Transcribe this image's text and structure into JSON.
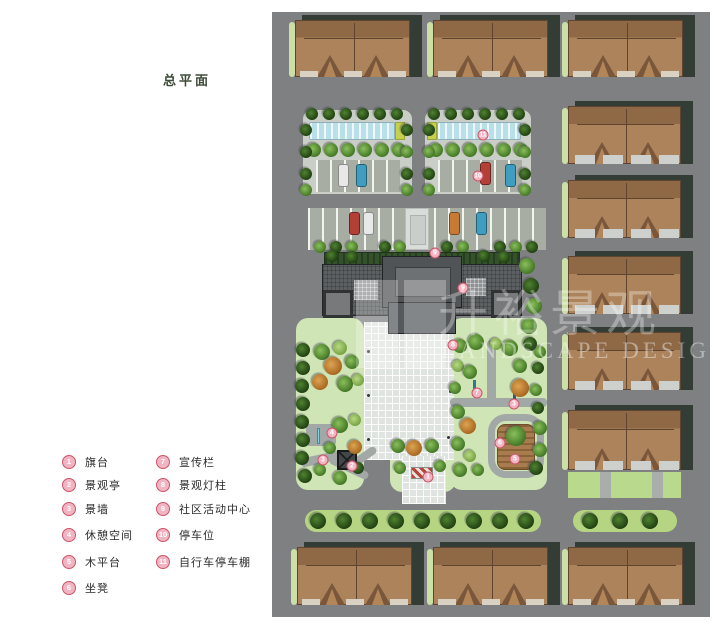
{
  "title": "总平面",
  "watermark": {
    "cn": "升裕景观",
    "en": "LANDSCAPE DESIGN"
  },
  "legend": {
    "col1": [
      {
        "n": "1",
        "label": "旗台"
      },
      {
        "n": "2",
        "label": "景观亭"
      },
      {
        "n": "3",
        "label": "景墙"
      },
      {
        "n": "4",
        "label": "休憩空间"
      },
      {
        "n": "5",
        "label": "木平台"
      },
      {
        "n": "6",
        "label": "坐凳"
      }
    ],
    "col2": [
      {
        "n": "7",
        "label": "宣传栏"
      },
      {
        "n": "8",
        "label": "景观灯柱"
      },
      {
        "n": "9",
        "label": "社区活动中心"
      },
      {
        "n": "10",
        "label": "停车位"
      },
      {
        "n": "11",
        "label": "自行车停车棚"
      }
    ]
  },
  "colors": {
    "road": "#7e8082",
    "roof": "#ad835b",
    "roofDark": "#8f6845",
    "shadow": "#343d35",
    "hedge": "#b5d583",
    "bed": "#cfe5b5",
    "plaza": "#e0e4e0",
    "shed": "#b9dfe8",
    "marker": "#cc5468",
    "carRed": "#b33f36",
    "carBlue": "#3f9ec0",
    "carOrange": "#c77a35",
    "carWhite": "#e8e8e8"
  },
  "plan": {
    "items": [
      {
        "t": "pad",
        "x": 31,
        "y": 98,
        "w": 109,
        "h": 84
      },
      {
        "t": "pad",
        "x": 153,
        "y": 98,
        "w": 106,
        "h": 84
      },
      {
        "t": "house",
        "x": 23,
        "y": 8,
        "w": 115,
        "h": 57,
        "v": "a"
      },
      {
        "t": "house",
        "x": 161,
        "y": 8,
        "w": 115,
        "h": 57,
        "v": "a"
      },
      {
        "t": "house",
        "x": 296,
        "y": 8,
        "w": 115,
        "h": 57,
        "v": "a"
      },
      {
        "t": "house",
        "x": 296,
        "y": 94,
        "w": 113,
        "h": 58,
        "v": "b"
      },
      {
        "t": "house",
        "x": 296,
        "y": 168,
        "w": 113,
        "h": 58,
        "v": "b"
      },
      {
        "t": "house",
        "x": 296,
        "y": 244,
        "w": 113,
        "h": 58,
        "v": "b"
      },
      {
        "t": "house",
        "x": 296,
        "y": 320,
        "w": 113,
        "h": 58,
        "v": "b"
      },
      {
        "t": "house",
        "x": 296,
        "y": 398,
        "w": 113,
        "h": 60,
        "v": "b"
      },
      {
        "t": "house",
        "x": 25,
        "y": 535,
        "w": 115,
        "h": 58,
        "v": "a"
      },
      {
        "t": "house",
        "x": 161,
        "y": 535,
        "w": 115,
        "h": 58,
        "v": "a"
      },
      {
        "t": "house",
        "x": 296,
        "y": 535,
        "w": 115,
        "h": 58,
        "v": "a"
      },
      {
        "t": "shed",
        "x": 37,
        "y": 110,
        "w": 86,
        "h": 18
      },
      {
        "t": "cap",
        "x": 123,
        "y": 110,
        "w": 10,
        "h": 18
      },
      {
        "t": "cap",
        "x": 155,
        "y": 110,
        "w": 10,
        "h": 18
      },
      {
        "t": "shed",
        "x": 165,
        "y": 110,
        "w": 84,
        "h": 18
      },
      {
        "t": "stalls",
        "x": 44,
        "y": 148,
        "w": 84,
        "h": 32
      },
      {
        "t": "stalls",
        "x": 166,
        "y": 148,
        "w": 84,
        "h": 32
      },
      {
        "t": "stalls",
        "x": 36,
        "y": 196,
        "w": 238,
        "h": 42
      },
      {
        "t": "walk",
        "x": 133,
        "y": 196,
        "w": 24,
        "h": 42
      },
      {
        "t": "trow",
        "x": 40,
        "y": 102,
        "n": 6,
        "dx": 17,
        "r": 6,
        "p": "dark"
      },
      {
        "t": "trow",
        "x": 162,
        "y": 102,
        "n": 6,
        "dx": 17,
        "r": 6,
        "p": "dark"
      },
      {
        "t": "trow",
        "x": 42,
        "y": 138,
        "n": 6,
        "dx": 17,
        "r": 7,
        "p": "green"
      },
      {
        "t": "trow",
        "x": 164,
        "y": 138,
        "n": 6,
        "dx": 17,
        "r": 7,
        "p": "green"
      },
      {
        "t": "tree",
        "x": 34,
        "y": 118,
        "r": 6,
        "p": "dark"
      },
      {
        "t": "tree",
        "x": 34,
        "y": 140,
        "r": 6,
        "p": "dark"
      },
      {
        "t": "tree",
        "x": 34,
        "y": 162,
        "r": 6,
        "p": "dark"
      },
      {
        "t": "tree",
        "x": 34,
        "y": 178,
        "r": 6,
        "p": "green"
      },
      {
        "t": "tree",
        "x": 135,
        "y": 118,
        "r": 6,
        "p": "dark"
      },
      {
        "t": "tree",
        "x": 135,
        "y": 140,
        "r": 6,
        "p": "green"
      },
      {
        "t": "tree",
        "x": 135,
        "y": 162,
        "r": 6,
        "p": "dark"
      },
      {
        "t": "tree",
        "x": 135,
        "y": 178,
        "r": 6,
        "p": "green"
      },
      {
        "t": "tree",
        "x": 157,
        "y": 118,
        "r": 6,
        "p": "dark"
      },
      {
        "t": "tree",
        "x": 157,
        "y": 140,
        "r": 6,
        "p": "green"
      },
      {
        "t": "tree",
        "x": 157,
        "y": 162,
        "r": 6,
        "p": "dark"
      },
      {
        "t": "tree",
        "x": 157,
        "y": 178,
        "r": 6,
        "p": "green"
      },
      {
        "t": "tree",
        "x": 253,
        "y": 118,
        "r": 6,
        "p": "dark"
      },
      {
        "t": "tree",
        "x": 253,
        "y": 140,
        "r": 6,
        "p": "green"
      },
      {
        "t": "tree",
        "x": 253,
        "y": 162,
        "r": 6,
        "p": "dark"
      },
      {
        "t": "tree",
        "x": 253,
        "y": 178,
        "r": 6,
        "p": "green"
      },
      {
        "t": "car",
        "x": 66,
        "y": 152,
        "c": "#e8e8e8"
      },
      {
        "t": "car",
        "x": 84,
        "y": 152,
        "c": "#3f9ec0"
      },
      {
        "t": "car",
        "x": 208,
        "y": 150,
        "c": "#b33f36"
      },
      {
        "t": "car",
        "x": 233,
        "y": 152,
        "c": "#3f9ec0"
      },
      {
        "t": "car",
        "x": 77,
        "y": 200,
        "c": "#b33f36"
      },
      {
        "t": "car",
        "x": 91,
        "y": 200,
        "c": "#e8e8e8"
      },
      {
        "t": "car",
        "x": 177,
        "y": 200,
        "c": "#c77a35"
      },
      {
        "t": "car",
        "x": 204,
        "y": 200,
        "c": "#3f9ec0"
      },
      {
        "t": "tree",
        "x": 48,
        "y": 235,
        "r": 6,
        "p": "green"
      },
      {
        "t": "tree",
        "x": 64,
        "y": 235,
        "r": 6,
        "p": "dark"
      },
      {
        "t": "tree",
        "x": 80,
        "y": 235,
        "r": 6,
        "p": "green"
      },
      {
        "t": "tree",
        "x": 113,
        "y": 235,
        "r": 6,
        "p": "dark"
      },
      {
        "t": "tree",
        "x": 128,
        "y": 235,
        "r": 6,
        "p": "green"
      },
      {
        "t": "tree",
        "x": 175,
        "y": 235,
        "r": 6,
        "p": "dark"
      },
      {
        "t": "tree",
        "x": 191,
        "y": 235,
        "r": 6,
        "p": "green"
      },
      {
        "t": "tree",
        "x": 228,
        "y": 235,
        "r": 6,
        "p": "dark"
      },
      {
        "t": "tree",
        "x": 244,
        "y": 235,
        "r": 6,
        "p": "green"
      },
      {
        "t": "tree",
        "x": 260,
        "y": 235,
        "r": 6,
        "p": "dark"
      },
      {
        "t": "bed",
        "x": 24,
        "y": 306,
        "w": 68,
        "h": 172
      },
      {
        "t": "bed",
        "x": 178,
        "y": 306,
        "w": 97,
        "h": 172
      },
      {
        "t": "bed",
        "x": 118,
        "y": 428,
        "w": 66,
        "h": 52
      },
      {
        "t": "plaza",
        "x": 92,
        "y": 310,
        "w": 90,
        "h": 138
      },
      {
        "t": "plaza",
        "x": 130,
        "y": 444,
        "w": 44,
        "h": 48
      },
      {
        "t": "building",
        "x": 50,
        "y": 238,
        "w": 200,
        "h": 84
      },
      {
        "t": "tree",
        "x": 255,
        "y": 254,
        "r": 8,
        "p": "green"
      },
      {
        "t": "tree",
        "x": 259,
        "y": 274,
        "r": 8,
        "p": "dark"
      },
      {
        "t": "tree",
        "x": 262,
        "y": 294,
        "r": 8,
        "p": "green"
      },
      {
        "t": "tree",
        "x": 257,
        "y": 314,
        "r": 8,
        "p": "green"
      },
      {
        "t": "tree",
        "x": 60,
        "y": 244,
        "r": 6,
        "p": "dark"
      },
      {
        "t": "tree",
        "x": 80,
        "y": 245,
        "r": 6,
        "p": "dark"
      },
      {
        "t": "tree",
        "x": 212,
        "y": 244,
        "r": 6,
        "p": "dark"
      },
      {
        "t": "tree",
        "x": 232,
        "y": 245,
        "r": 6,
        "p": "dark"
      },
      {
        "t": "path",
        "x": 34,
        "y": 412,
        "w": 30,
        "h": 22
      },
      {
        "t": "path",
        "x": 28,
        "y": 442,
        "w": 46,
        "h": 9,
        "rot": -12
      },
      {
        "t": "path",
        "x": 56,
        "y": 452,
        "w": 42,
        "h": 8,
        "rot": 25
      },
      {
        "t": "path",
        "x": 80,
        "y": 440,
        "w": 26,
        "h": 8,
        "rot": -35
      },
      {
        "t": "bench",
        "x": 45,
        "y": 416,
        "w": 3,
        "h": 16
      },
      {
        "t": "pav",
        "x": 65,
        "y": 438,
        "w": 20,
        "h": 20
      },
      {
        "t": "path",
        "x": 215,
        "y": 328,
        "w": 9,
        "h": 62
      },
      {
        "t": "path",
        "x": 178,
        "y": 386,
        "w": 97,
        "h": 9
      },
      {
        "t": "loop",
        "x": 216,
        "y": 402,
        "w": 56,
        "h": 64
      },
      {
        "t": "deck",
        "x": 225,
        "y": 412,
        "w": 38,
        "h": 46
      },
      {
        "t": "tree",
        "x": 244,
        "y": 424,
        "r": 10,
        "p": "green"
      },
      {
        "t": "wall",
        "x": 241,
        "y": 372,
        "w": 3,
        "h": 17
      },
      {
        "t": "bulletin",
        "x": 201,
        "y": 368,
        "w": 3,
        "h": 14
      },
      {
        "t": "lamp",
        "x": 95,
        "y": 338
      },
      {
        "t": "lamp",
        "x": 95,
        "y": 382
      },
      {
        "t": "lamp",
        "x": 95,
        "y": 426
      },
      {
        "t": "lamp",
        "x": 179,
        "y": 330
      },
      {
        "t": "lamp",
        "x": 177,
        "y": 378
      },
      {
        "t": "lamp",
        "x": 175,
        "y": 424
      },
      {
        "t": "tree",
        "x": 31,
        "y": 338,
        "r": 7,
        "p": "dark"
      },
      {
        "t": "tree",
        "x": 31,
        "y": 356,
        "r": 7,
        "p": "dark"
      },
      {
        "t": "tree",
        "x": 30,
        "y": 374,
        "r": 7,
        "p": "dark"
      },
      {
        "t": "tree",
        "x": 31,
        "y": 392,
        "r": 7,
        "p": "dark"
      },
      {
        "t": "tree",
        "x": 30,
        "y": 410,
        "r": 7,
        "p": "dark"
      },
      {
        "t": "tree",
        "x": 31,
        "y": 428,
        "r": 7,
        "p": "dark"
      },
      {
        "t": "tree",
        "x": 30,
        "y": 446,
        "r": 7,
        "p": "dark"
      },
      {
        "t": "tree",
        "x": 33,
        "y": 464,
        "r": 7,
        "p": "dark"
      },
      {
        "t": "tree",
        "x": 50,
        "y": 340,
        "r": 8,
        "p": "green"
      },
      {
        "t": "tree",
        "x": 68,
        "y": 336,
        "r": 7,
        "p": "lime"
      },
      {
        "t": "tree",
        "x": 61,
        "y": 354,
        "r": 9,
        "p": "orange"
      },
      {
        "t": "tree",
        "x": 80,
        "y": 350,
        "r": 7,
        "p": "green"
      },
      {
        "t": "tree",
        "x": 48,
        "y": 370,
        "r": 8,
        "p": "orange"
      },
      {
        "t": "tree",
        "x": 73,
        "y": 372,
        "r": 8,
        "p": "green"
      },
      {
        "t": "tree",
        "x": 86,
        "y": 368,
        "r": 6,
        "p": "lime"
      },
      {
        "t": "tree",
        "x": 68,
        "y": 413,
        "r": 8,
        "p": "green"
      },
      {
        "t": "tree",
        "x": 83,
        "y": 408,
        "r": 6,
        "p": "lime"
      },
      {
        "t": "tree",
        "x": 58,
        "y": 436,
        "r": 6,
        "p": "green"
      },
      {
        "t": "tree",
        "x": 83,
        "y": 435,
        "r": 7,
        "p": "orange"
      },
      {
        "t": "tree",
        "x": 48,
        "y": 458,
        "r": 6,
        "p": "green"
      },
      {
        "t": "tree",
        "x": 68,
        "y": 466,
        "r": 7,
        "p": "green"
      },
      {
        "t": "tree",
        "x": 86,
        "y": 456,
        "r": 6,
        "p": "dark"
      },
      {
        "t": "tree",
        "x": 188,
        "y": 334,
        "r": 7,
        "p": "green"
      },
      {
        "t": "tree",
        "x": 204,
        "y": 330,
        "r": 8,
        "p": "green"
      },
      {
        "t": "tree",
        "x": 224,
        "y": 332,
        "r": 6,
        "p": "lime"
      },
      {
        "t": "tree",
        "x": 238,
        "y": 336,
        "r": 8,
        "p": "green"
      },
      {
        "t": "tree",
        "x": 258,
        "y": 332,
        "r": 7,
        "p": "dark"
      },
      {
        "t": "tree",
        "x": 268,
        "y": 340,
        "r": 6,
        "p": "green"
      },
      {
        "t": "tree",
        "x": 186,
        "y": 354,
        "r": 6,
        "p": "lime"
      },
      {
        "t": "tree",
        "x": 198,
        "y": 360,
        "r": 7,
        "p": "green"
      },
      {
        "t": "tree",
        "x": 248,
        "y": 354,
        "r": 7,
        "p": "green"
      },
      {
        "t": "tree",
        "x": 266,
        "y": 356,
        "r": 6,
        "p": "dark"
      },
      {
        "t": "tree",
        "x": 248,
        "y": 376,
        "r": 9,
        "p": "orange"
      },
      {
        "t": "tree",
        "x": 264,
        "y": 378,
        "r": 6,
        "p": "green"
      },
      {
        "t": "tree",
        "x": 183,
        "y": 376,
        "r": 6,
        "p": "green"
      },
      {
        "t": "tree",
        "x": 186,
        "y": 400,
        "r": 7,
        "p": "green"
      },
      {
        "t": "tree",
        "x": 196,
        "y": 414,
        "r": 8,
        "p": "orange"
      },
      {
        "t": "tree",
        "x": 186,
        "y": 432,
        "r": 7,
        "p": "green"
      },
      {
        "t": "tree",
        "x": 198,
        "y": 444,
        "r": 6,
        "p": "lime"
      },
      {
        "t": "tree",
        "x": 188,
        "y": 458,
        "r": 7,
        "p": "green"
      },
      {
        "t": "tree",
        "x": 206,
        "y": 458,
        "r": 6,
        "p": "green"
      },
      {
        "t": "tree",
        "x": 266,
        "y": 396,
        "r": 6,
        "p": "dark"
      },
      {
        "t": "tree",
        "x": 268,
        "y": 416,
        "r": 7,
        "p": "green"
      },
      {
        "t": "tree",
        "x": 268,
        "y": 438,
        "r": 7,
        "p": "green"
      },
      {
        "t": "tree",
        "x": 264,
        "y": 456,
        "r": 7,
        "p": "dark"
      },
      {
        "t": "tree",
        "x": 126,
        "y": 434,
        "r": 7,
        "p": "green"
      },
      {
        "t": "tree",
        "x": 142,
        "y": 436,
        "r": 8,
        "p": "orange"
      },
      {
        "t": "tree",
        "x": 160,
        "y": 434,
        "r": 7,
        "p": "green"
      },
      {
        "t": "tree",
        "x": 128,
        "y": 456,
        "r": 6,
        "p": "green"
      },
      {
        "t": "tree",
        "x": 168,
        "y": 454,
        "r": 6,
        "p": "green"
      },
      {
        "t": "flag",
        "x": 139,
        "y": 455,
        "w": 22,
        "h": 12
      },
      {
        "t": "hedge",
        "x": 33,
        "y": 498,
        "w": 236,
        "h": 22
      },
      {
        "t": "trow",
        "x": 46,
        "y": 509,
        "n": 9,
        "dx": 26,
        "r": 8,
        "p": "dark"
      },
      {
        "t": "hedge",
        "x": 301,
        "y": 498,
        "w": 104,
        "h": 22
      },
      {
        "t": "trow",
        "x": 318,
        "y": 509,
        "n": 3,
        "dx": 30,
        "r": 8,
        "p": "dark"
      },
      {
        "t": "lawn",
        "x": 296,
        "y": 460,
        "w": 113,
        "h": 26
      },
      {
        "t": "lawnbar",
        "x": 328,
        "y": 460,
        "w": 11,
        "h": 26
      },
      {
        "t": "lawnbar",
        "x": 380,
        "y": 460,
        "w": 11,
        "h": 26
      },
      {
        "t": "marker",
        "n": "11",
        "x": 211,
        "y": 123
      },
      {
        "t": "marker",
        "n": "10",
        "x": 206,
        "y": 164
      },
      {
        "t": "marker",
        "n": "9",
        "x": 163,
        "y": 241
      },
      {
        "t": "marker",
        "n": "9",
        "x": 191,
        "y": 276
      },
      {
        "t": "marker",
        "n": "8",
        "x": 181,
        "y": 333
      },
      {
        "t": "marker",
        "n": "7",
        "x": 205,
        "y": 381
      },
      {
        "t": "marker",
        "n": "3",
        "x": 242,
        "y": 392
      },
      {
        "t": "marker",
        "n": "4",
        "x": 60,
        "y": 421
      },
      {
        "t": "marker",
        "n": "6",
        "x": 228,
        "y": 431
      },
      {
        "t": "marker",
        "n": "5",
        "x": 243,
        "y": 447
      },
      {
        "t": "marker",
        "n": "3",
        "x": 51,
        "y": 448
      },
      {
        "t": "marker",
        "n": "2",
        "x": 80,
        "y": 454
      },
      {
        "t": "marker",
        "n": "1",
        "x": 156,
        "y": 465
      }
    ]
  }
}
